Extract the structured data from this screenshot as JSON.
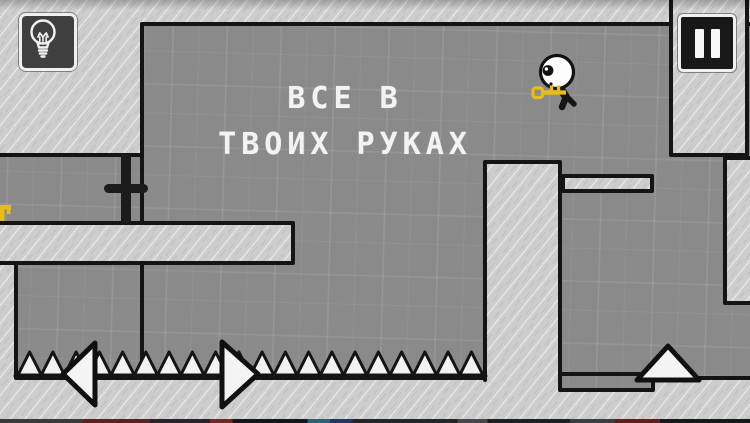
{
  "hud": {
    "hint_button": {
      "icon": "lightbulb-icon"
    },
    "pause_button": {
      "icon": "pause-icon"
    }
  },
  "level": {
    "message": {
      "line1": "ВСЕ В",
      "line2": "ТВОИХ РУКАХ"
    },
    "spikes": {
      "count": 20,
      "x_from": 18,
      "x_to": 483,
      "base_y": 375,
      "tip_height": 23
    },
    "objects": [
      "player-character",
      "key",
      "lever",
      "key-fragment-left-edge",
      "move-left-arrow",
      "move-right-arrow",
      "jump-arrow",
      "spike-row"
    ]
  },
  "colors": {
    "play_area_gray": "#8a8a8a",
    "wall_light_gray": "#cdcdcd",
    "outline_black": "#141414",
    "spike_white": "#f2f2f2",
    "key_gold": "#e9bd13",
    "text_white": "#f3f3f3",
    "button_dark": "#3f3f3f",
    "pause_dark": "#181818",
    "button_border_white": "#f0f0f0"
  }
}
